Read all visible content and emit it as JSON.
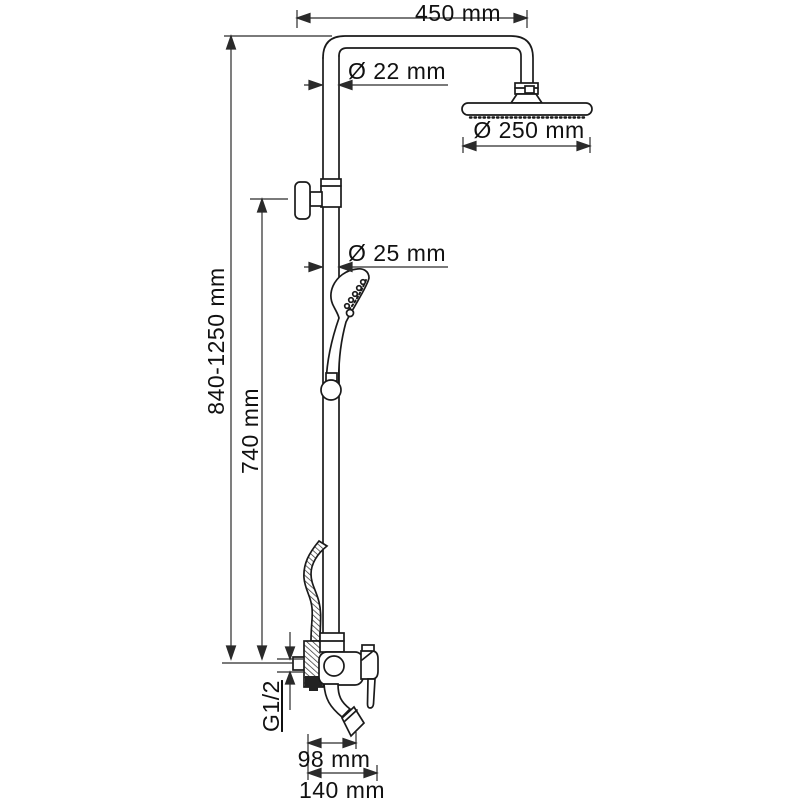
{
  "drawing": {
    "title": "shower-column-technical-drawing",
    "colors": {
      "line": "#1a1a1a",
      "dim_line": "#2a2a2a",
      "background": "#ffffff"
    },
    "labels": {
      "top_width": "450 mm",
      "pipe_diameter": "Ø 22 mm",
      "head_diameter": "Ø 250 mm",
      "rail_diameter": "Ø 25 mm",
      "total_height": "840-1250 mm",
      "rail_height": "740 mm",
      "thread": "G1/2",
      "spout_reach": "98 mm",
      "spout_total": "140 mm"
    }
  }
}
